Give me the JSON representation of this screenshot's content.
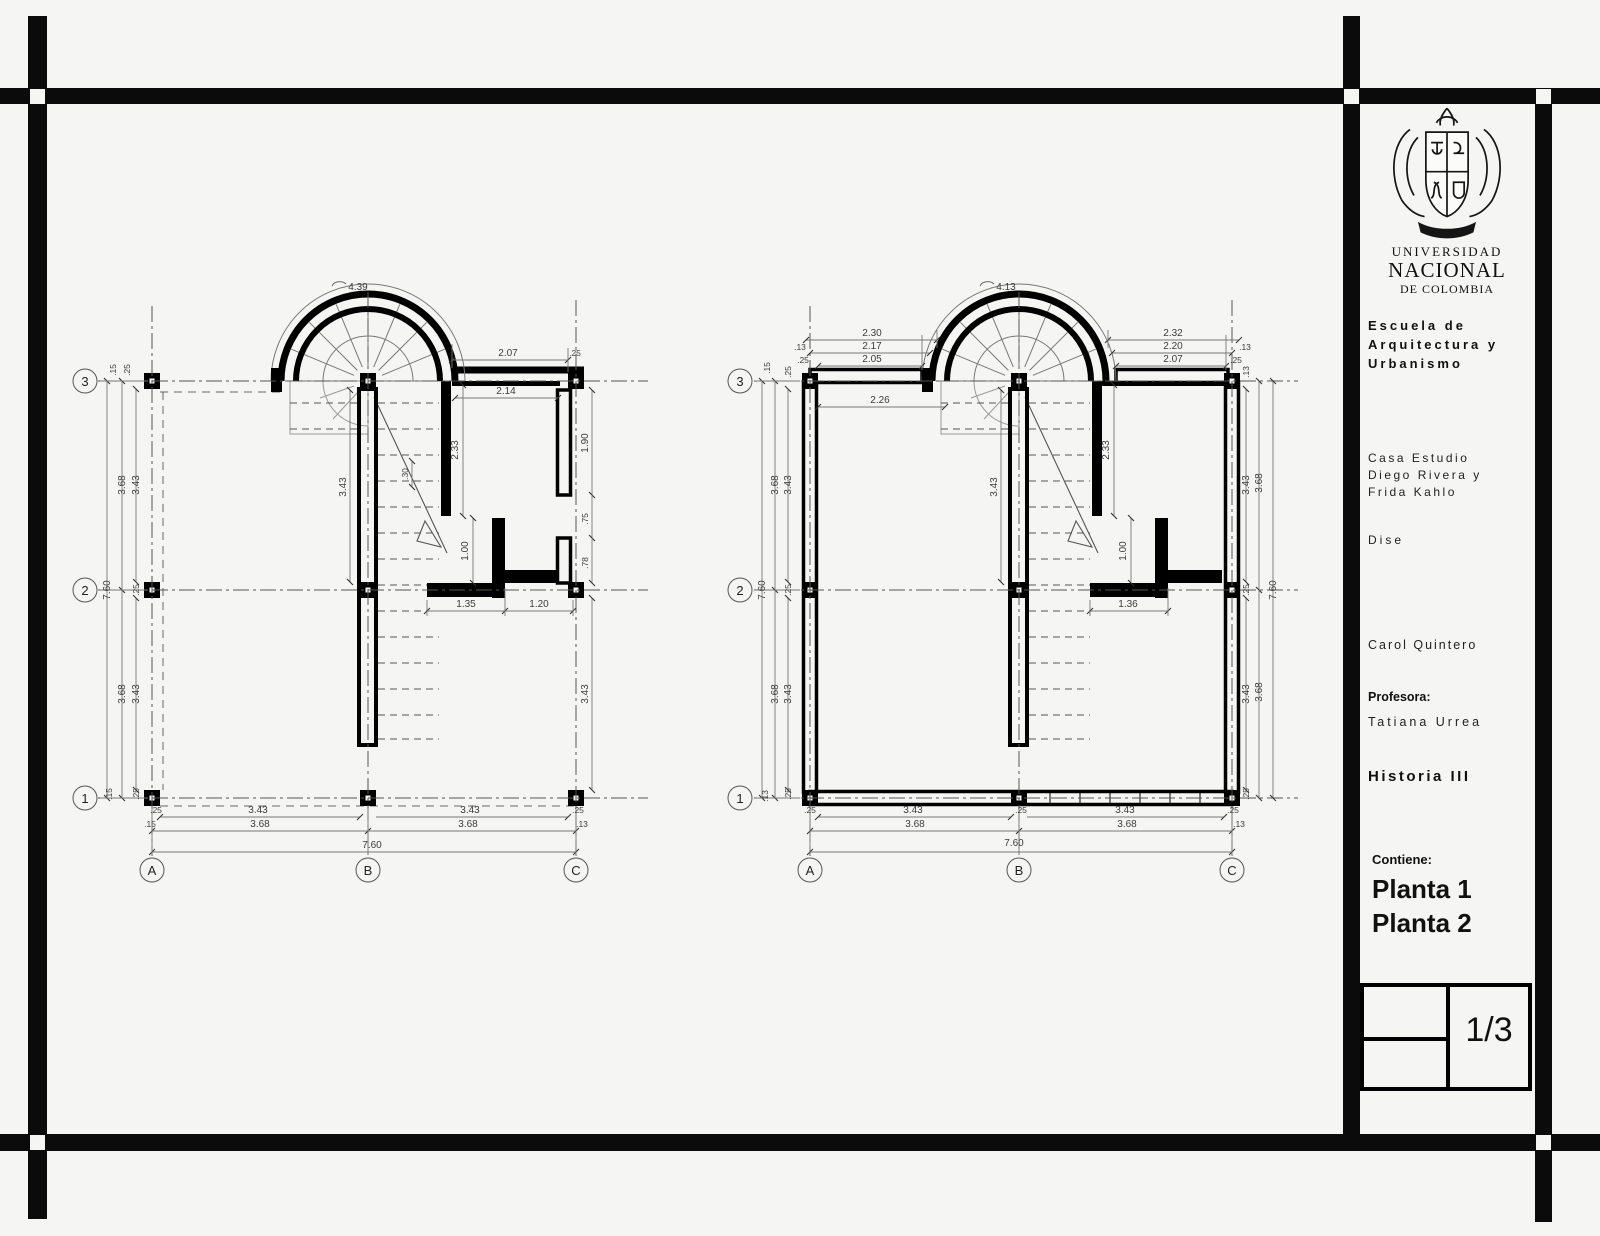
{
  "title_block": {
    "university_line1": "UNIVERSIDAD",
    "university_line2": "NACIONAL",
    "university_line3": "DE COLOMBIA",
    "school_line1": "Escuela de",
    "school_line2": "Arquitectura y",
    "school_line3": "Urbanismo",
    "project_line1": "Casa Estudio",
    "project_line2": "Diego Rivera y",
    "project_line3": "Frida Kahlo",
    "design_text": "Dise",
    "student": "Carol Quintero",
    "professor_label": "Profesora:",
    "professor_name": "Tatiana Urrea",
    "course": "Historia III",
    "contains_label": "Contiene:",
    "content_line1": "Planta 1",
    "content_line2": "Planta 2",
    "sheet_number": "1/3"
  },
  "grid_labels": {
    "row1": "1",
    "row2": "2",
    "row3": "3",
    "colA": "A",
    "colB": "B",
    "colC": "C"
  },
  "dims": {
    "d013": ".13",
    "d015": ".15",
    "d025": ".25",
    "d030": ".30",
    "d075": ".75",
    "d078": ".78",
    "d100": "1.00",
    "d120": "1.20",
    "d135": "1.35",
    "d136": "1.36",
    "d190": "1.90",
    "d205": "2.05",
    "d207": "2.07",
    "d214": "2.14",
    "d217": "2.17",
    "d220": "2.20",
    "d226": "2.26",
    "d230": "2.30",
    "d232": "2.32",
    "d233": "2.33",
    "d343": "3.43",
    "d368": "3.68",
    "d413": "4.13",
    "d439": "4.39",
    "d760": "7.60"
  }
}
